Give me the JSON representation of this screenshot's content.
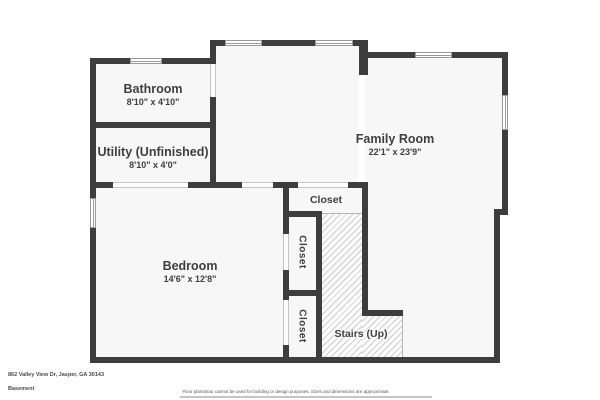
{
  "plan": {
    "type": "floor-plan",
    "rooms": [
      {
        "id": "bathroom",
        "name": "Bathroom",
        "dims": "8'10\" x 4'10\""
      },
      {
        "id": "utility",
        "name": "Utility (Unfinished)",
        "dims": "8'10\" x 4'0\""
      },
      {
        "id": "family-room",
        "name": "Family Room",
        "dims": "22'1\" x 23'9\""
      },
      {
        "id": "bedroom",
        "name": "Bedroom",
        "dims": "14'6\" x 12'8\""
      },
      {
        "id": "closet-top",
        "name": "Closet"
      },
      {
        "id": "closet-middle",
        "name": "Closet"
      },
      {
        "id": "closet-bottom",
        "name": "Closet"
      },
      {
        "id": "stairs",
        "name": "Stairs (Up)"
      }
    ]
  },
  "footer": {
    "address": "862 Valley View Dr, Jasper, GA 30143",
    "floor_label": "Basement",
    "disclaimer": "Floor plans/tour cannot be used for building or design purposes. Sizes and dimensions are approximate."
  },
  "colors": {
    "wall": "#3d3d3d",
    "floor_fill": "#f7f7f7",
    "hatch_line": "#cdcdcd",
    "text": "#3f3f3f",
    "window_outline": "#9a9a9a"
  }
}
